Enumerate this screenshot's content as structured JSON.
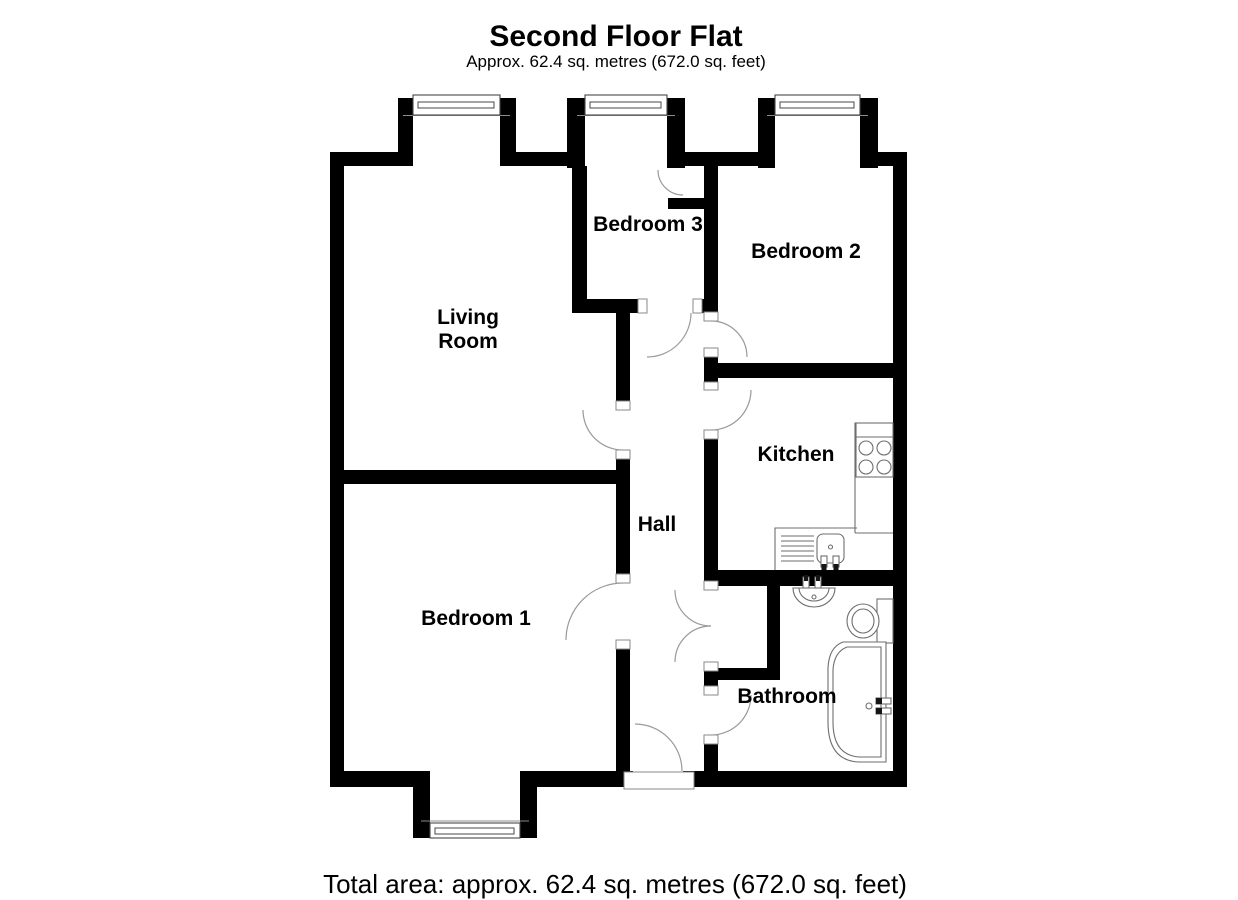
{
  "title": "Second Floor Flat",
  "subtitle": "Approx. 62.4 sq. metres (672.0 sq. feet)",
  "rooms": {
    "living_room": {
      "line1": "Living",
      "line2": "Room"
    },
    "bedroom1": {
      "label": "Bedroom 1"
    },
    "bedroom2": {
      "label": "Bedroom 2"
    },
    "bedroom3": {
      "label": "Bedroom 3"
    },
    "kitchen": {
      "label": "Kitchen"
    },
    "hall": {
      "label": "Hall"
    },
    "bathroom": {
      "label": "Bathroom"
    }
  },
  "footer": {
    "total_area": "Total area: approx. 62.4 sq. metres (672.0 sq. feet)"
  },
  "colors": {
    "wall": "#000000",
    "background": "#ffffff",
    "fixture_line": "#6e6e6e",
    "text": "#000000"
  }
}
